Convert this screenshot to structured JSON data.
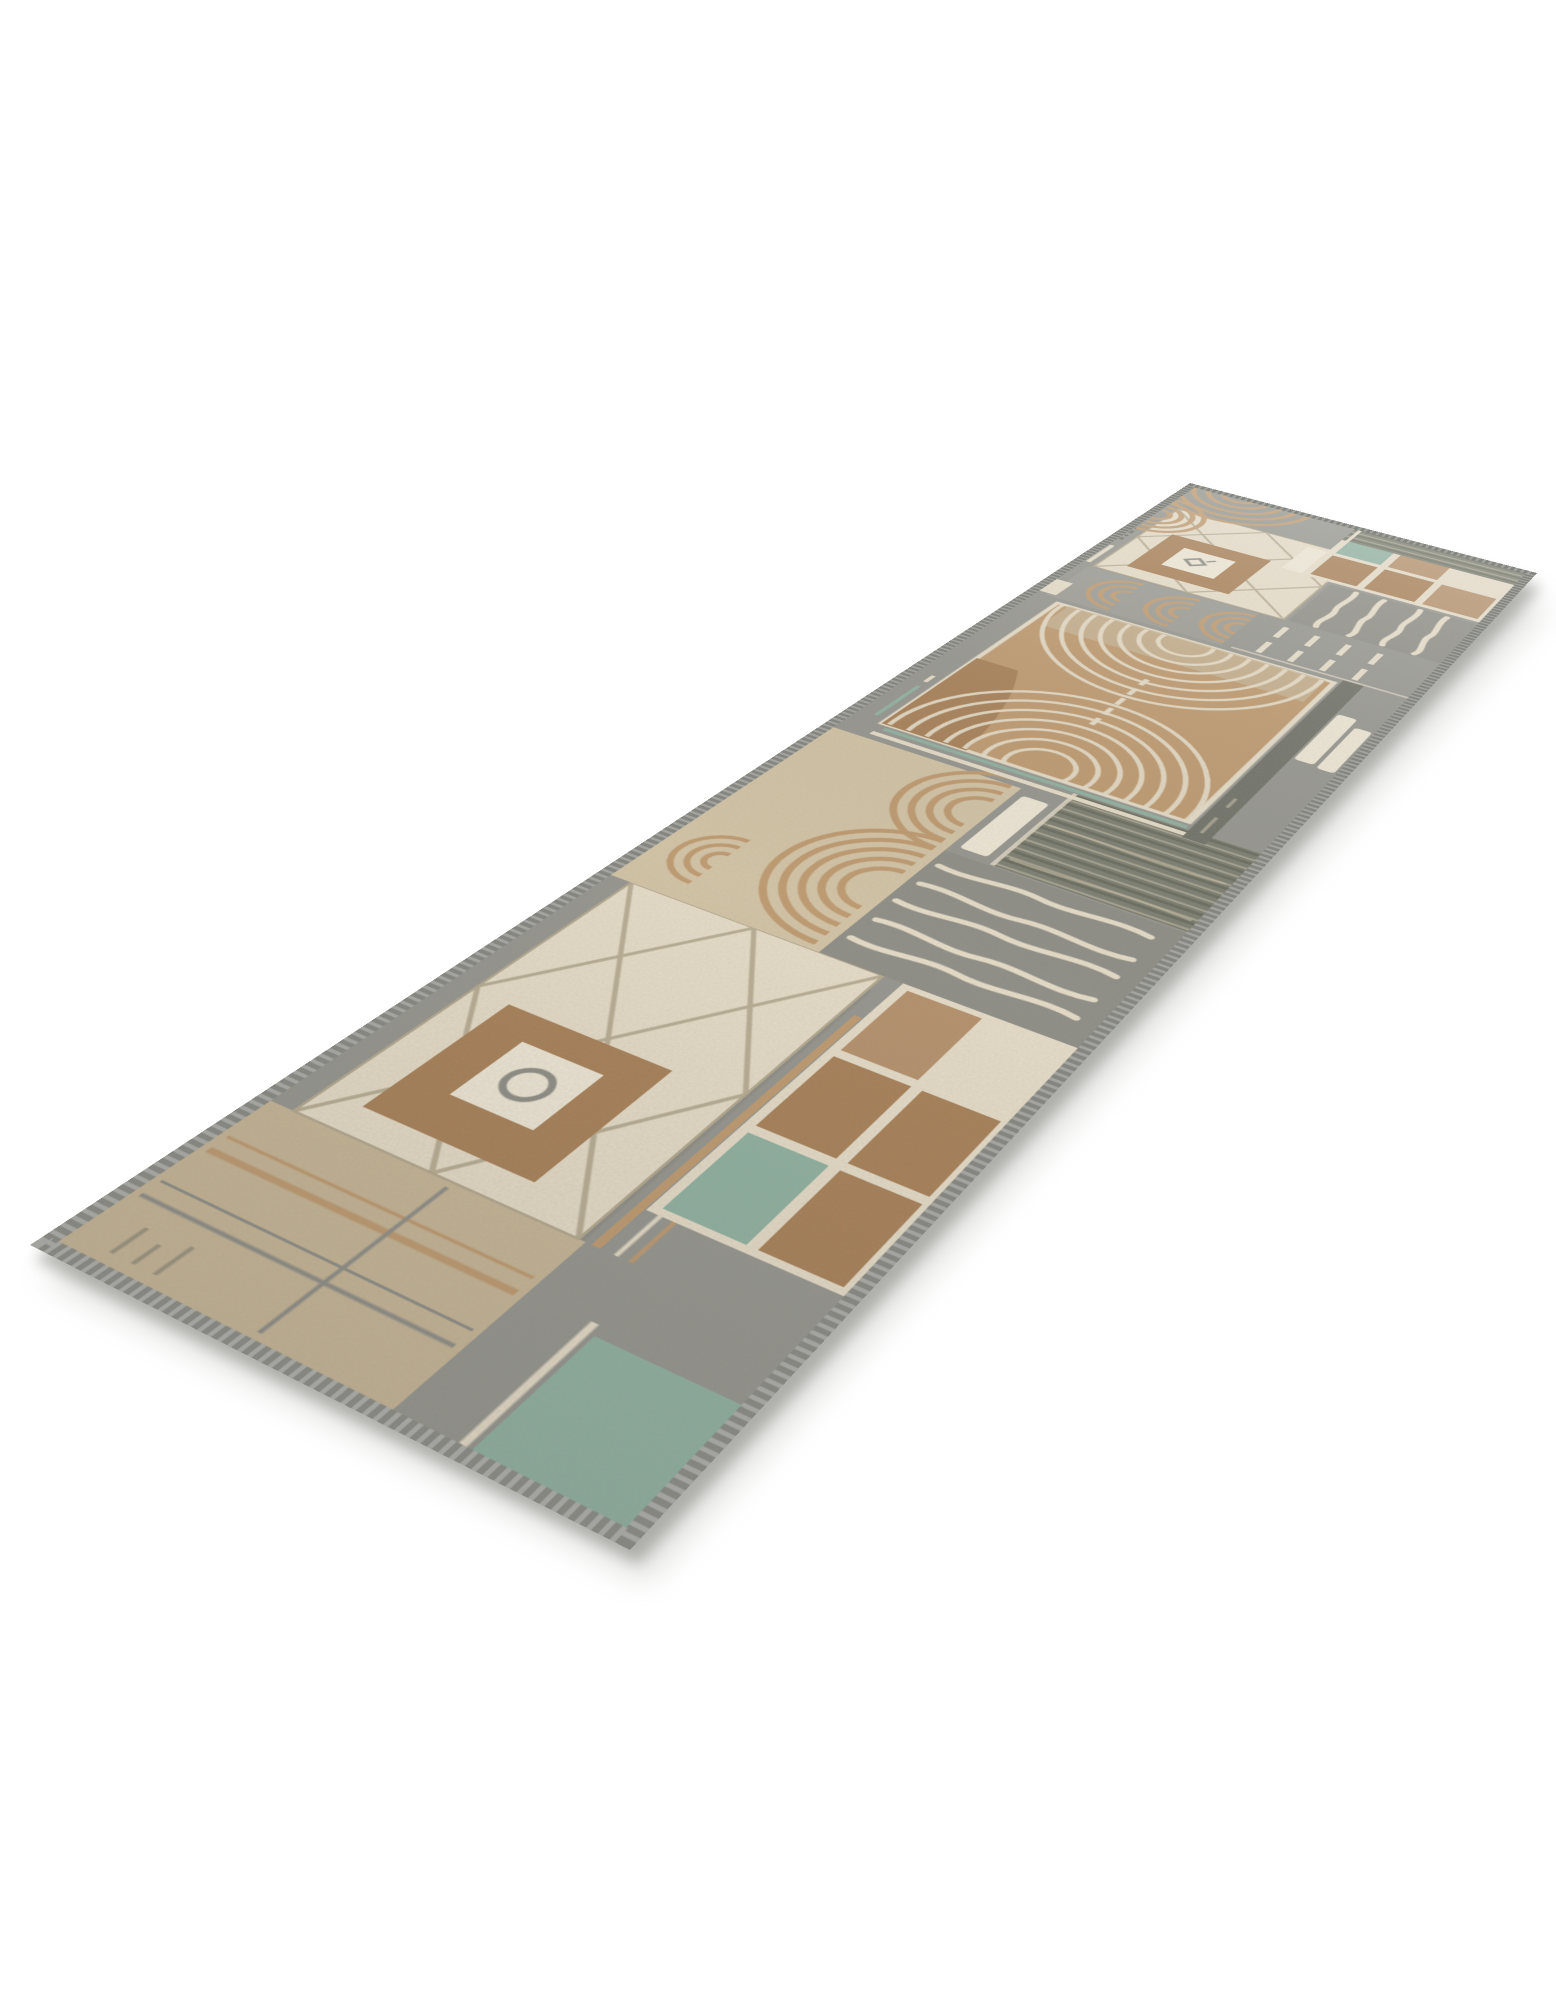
{
  "scene": {
    "type": "product photo",
    "subject": "geometric patchwork runner rug displayed diagonally on a plain white studio background",
    "background_color": "#ffffff",
    "rug": {
      "shape": "long runner, viewed in perspective from its near-left corner",
      "motifs": [
        "cream diamond/cross-line panels",
        "brown framed squares with small ring emblem",
        "square grids of brown tiles with cream joints and single teal tiles",
        "concentric arch (rainbow) motifs in tan",
        "large tan medallion with cream fingerprint arcs",
        "wavy cream stripe panels on gray",
        "dense dark striped blocks",
        "gray serged edge binding"
      ],
      "palette": {
        "gray": "#95958f",
        "gray2": "#8d8d86",
        "gray3": "#9b9b94",
        "grayDark": "#6e7066",
        "olive": "#7a7d6f",
        "oliveDark": "#676b5c",
        "cream": "#e9dfca",
        "creamBright": "#f2ead8",
        "beige": "#d5c5a6",
        "taupe": "#c9b797",
        "tan": "#c09a6e",
        "brown": "#a87f55",
        "brownLight": "#b6906a",
        "teal": "#8fb2a1",
        "line": "#b5a98f",
        "ring": "#8d8d85",
        "binding": "#84867f",
        "bindingDark": "#74766f",
        "shadow": "#9b9b94"
      }
    }
  }
}
